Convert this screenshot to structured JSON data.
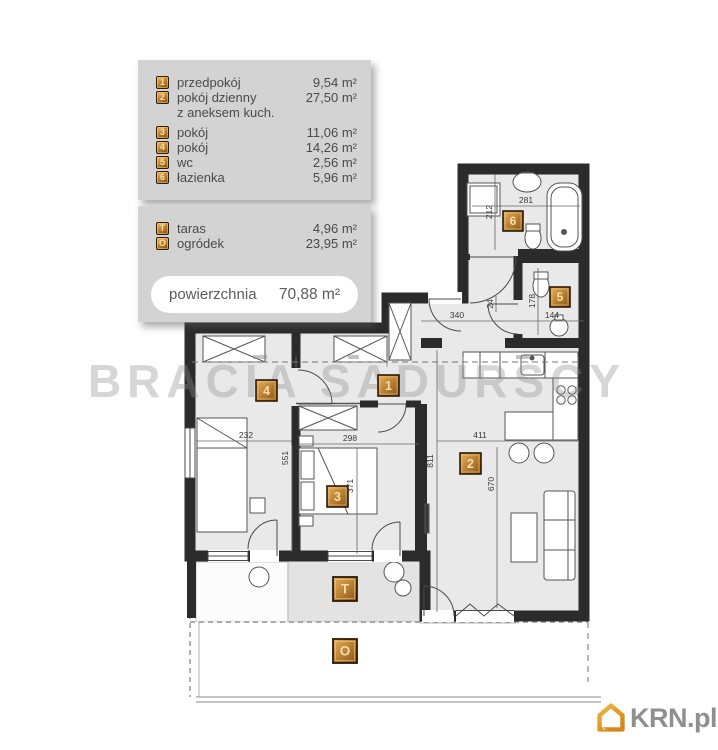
{
  "legend": {
    "rooms": [
      {
        "id": "1",
        "name": "przedpokój",
        "area": "9,54 m²"
      },
      {
        "id": "2",
        "name": "pokój dzienny",
        "name2": "z aneksem kuch.",
        "area": "27,50 m²"
      },
      {
        "id": "3",
        "name": "pokój",
        "area": "11,06 m²"
      },
      {
        "id": "4",
        "name": "pokój",
        "area": "14,26 m²"
      },
      {
        "id": "5",
        "name": "wc",
        "area": "2,56 m²"
      },
      {
        "id": "6",
        "name": "łazienka",
        "area": "5,96 m²"
      }
    ],
    "outdoor": [
      {
        "id": "T",
        "name": "taras",
        "area": "4,96 m²"
      },
      {
        "id": "O",
        "name": "ogródek",
        "area": "23,95 m²"
      }
    ],
    "total": {
      "label": "powierzchnia",
      "value": "70,88 m²"
    }
  },
  "plan": {
    "labels": {
      "hall": "1",
      "living": "2",
      "room3": "3",
      "room4": "4",
      "wc": "5",
      "bath": "6",
      "terrace": "T",
      "garden": "O"
    },
    "dims": {
      "bath_w": "281",
      "bath_h": "212",
      "wc_h": "178",
      "wc_w": "144",
      "vest": "24",
      "hall_w": "340",
      "r4_w": "232",
      "r4_h": "551",
      "r3_w": "298",
      "r3_h": "371",
      "r2_w": "411",
      "r2_h_full": "811",
      "r2_h": "670"
    },
    "colors": {
      "accent_orange": "#c98428",
      "floor_fill": "#e9e9e9",
      "wall": "#2b2b2b"
    }
  },
  "watermark": {
    "text": "BRACIA SADURSCY"
  },
  "logo": {
    "text": "KRN.pl",
    "icon": "house-icon"
  }
}
